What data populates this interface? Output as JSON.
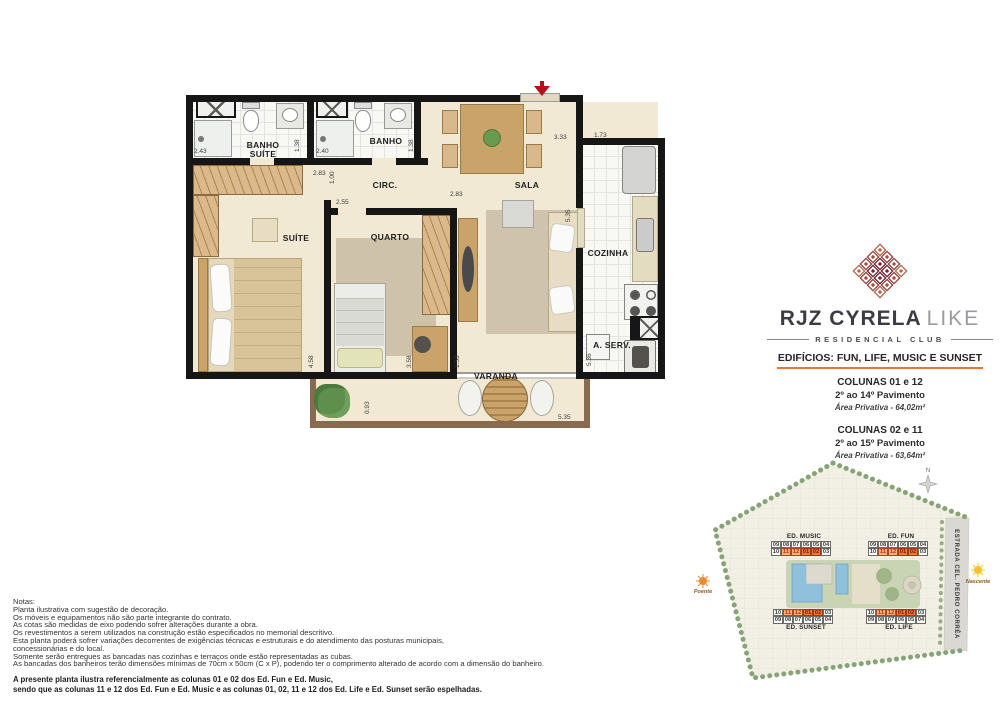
{
  "floorplan": {
    "labels": {
      "banho_suite": "BANHO SUÍTE",
      "banho": "BANHO",
      "circ": "CIRC.",
      "sala": "SALA",
      "suite": "SUÍTE",
      "quarto": "QUARTO",
      "cozinha": "COZINHA",
      "aserv": "A. SERV.",
      "varanda": "VARANDA"
    },
    "dims": [
      "2.43",
      "1.38",
      "2.40",
      "1.38",
      "2.83",
      "1.00",
      "2.55",
      "2.83",
      "3.33",
      "1.73",
      "5.35",
      "4.58",
      "3.58",
      "1.53",
      "5.36",
      "0.93",
      "5.35"
    ]
  },
  "brand": {
    "name": "RJZ CYRELA",
    "name_light": "LIKE",
    "tagline": "RESIDENCIAL CLUB",
    "logo_colors": [
      "#b5654a",
      "#a0503d",
      "#7a2230"
    ]
  },
  "spec": {
    "heading": "EDIFÍCIOS:  FUN, LIFE, MUSIC E SUNSET",
    "accent_color": "#e8743c",
    "blocks": [
      {
        "columns": "COLUNAS 01 e 12",
        "floors": "2º ao 14º Pavimento",
        "area": "Área Privativa - 64,02m²"
      },
      {
        "columns": "COLUNAS 02 e 11",
        "floors": "2º ao 15º Pavimento",
        "area": "Área Privativa - 63,64m²"
      }
    ]
  },
  "siteplan": {
    "street": "ESTRADA CEL. PEDRO CORRÊA",
    "compass": "N",
    "west_label": "Poente",
    "east_label": "Nascente",
    "highlight": {
      "11": "light",
      "12": "light",
      "01": "dark",
      "02": "dark"
    },
    "highlight_colors": {
      "light": "#f6b071",
      "dark": "#ee7b35"
    },
    "buildings": [
      {
        "name": "ED. MUSIC",
        "label_pos": "top",
        "highlight_row": 1,
        "rows": [
          [
            "09",
            "08",
            "07",
            "06",
            "05",
            "04"
          ],
          [
            "10",
            "11",
            "12",
            "01",
            "02",
            "03"
          ]
        ]
      },
      {
        "name": "ED. FUN",
        "label_pos": "top",
        "highlight_row": 1,
        "rows": [
          [
            "09",
            "08",
            "07",
            "06",
            "05",
            "04"
          ],
          [
            "10",
            "11",
            "12",
            "01",
            "02",
            "03"
          ]
        ]
      },
      {
        "name": "ED. SUNSET",
        "label_pos": "bottom",
        "highlight_row": 0,
        "rows": [
          [
            "10",
            "11",
            "12",
            "01",
            "02",
            "03"
          ],
          [
            "09",
            "08",
            "07",
            "06",
            "05",
            "04"
          ]
        ]
      },
      {
        "name": "ED. LIFE",
        "label_pos": "bottom",
        "highlight_row": 0,
        "rows": [
          [
            "10",
            "11",
            "12",
            "01",
            "02",
            "03"
          ],
          [
            "09",
            "08",
            "07",
            "06",
            "05",
            "04"
          ]
        ]
      }
    ]
  },
  "notes": {
    "title": "Notas:",
    "lines": [
      "Planta ilustrativa com sugestão de decoração.",
      "Os móveis e equipamentos não são parte integrante do contrato.",
      "As cotas são medidas de eixo podendo sofrer alterações durante a obra.",
      "Os revestimentos a serem utilizados na construção estão especificados no memorial descritivo.",
      "Esta planta poderá sofrer variações decorrentes de exigências técnicas e estruturais e do atendimento das posturas municipais,",
      "concessionárias e do local.",
      "Somente serão entregues as bancadas nas cozinhas e terraços onde estão representadas as cubas.",
      "As bancadas dos banheiros terão dimensões mínimas de 70cm x 50cm (C x P), podendo ter o comprimento alterado de acordo com a dimensão do banheiro."
    ],
    "emphasis": [
      "A presente planta ilustra referencialmente as colunas 01 e 02 dos Ed. Fun e Ed. Music,",
      "sendo que as colunas 11 e 12 dos Ed. Fun e Ed. Music e as colunas 01, 02, 11 e 12 dos Ed. Life e Ed. Sunset serão espelhadas."
    ]
  }
}
